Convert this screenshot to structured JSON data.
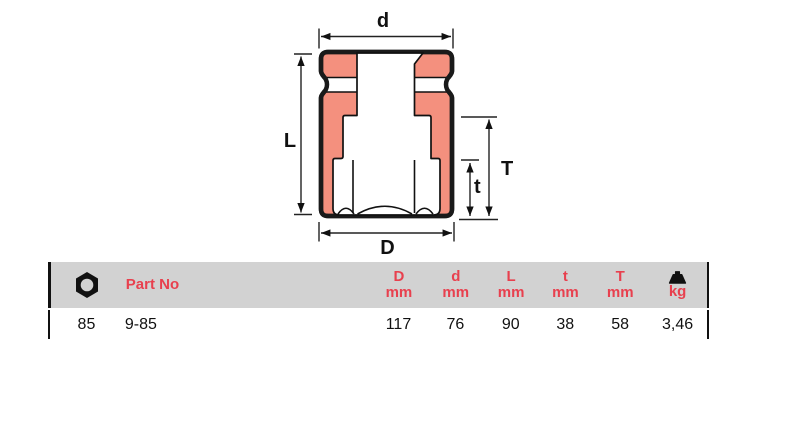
{
  "diagram": {
    "dim_labels": {
      "top_width": "d",
      "overall_height": "L",
      "total_inner_depth": "T",
      "hex_depth": "t",
      "bottom_width": "D"
    },
    "colors": {
      "section_fill": "#F4907E",
      "outline": "#1A1A1A"
    }
  },
  "table": {
    "colors": {
      "accent_red": "#E8404E",
      "header_bg": "#D2D2D2"
    },
    "header": {
      "size_icon": "hex-nut-icon",
      "part_no": "Part No",
      "columns": [
        {
          "dim": "D",
          "unit": "mm"
        },
        {
          "dim": "d",
          "unit": "mm"
        },
        {
          "dim": "L",
          "unit": "mm"
        },
        {
          "dim": "t",
          "unit": "mm"
        },
        {
          "dim": "T",
          "unit": "mm"
        }
      ],
      "weight_icon": "weight-icon",
      "weight_unit": "kg"
    },
    "rows": [
      {
        "size": "85",
        "part_no": "9-85",
        "D_mm": "117",
        "d_mm": "76",
        "L_mm": "90",
        "t_mm": "38",
        "T_mm": "58",
        "weight_kg": "3,46"
      }
    ]
  }
}
